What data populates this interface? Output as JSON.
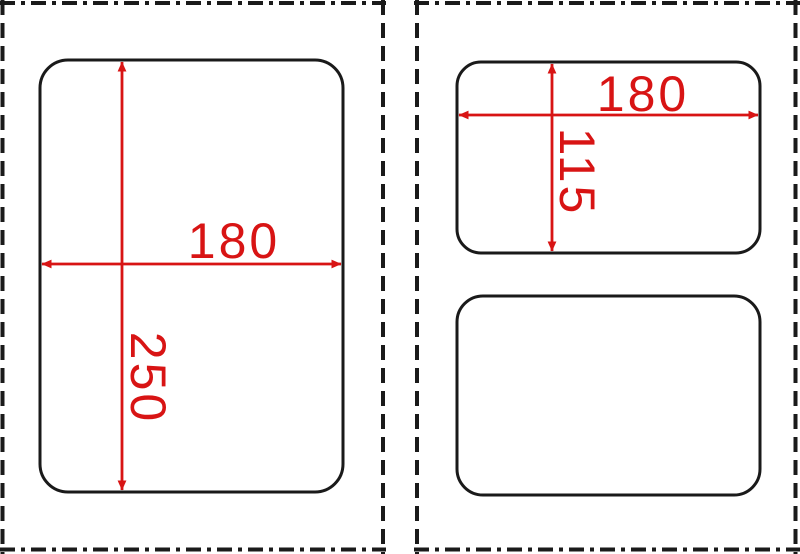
{
  "colors": {
    "outline_black": "#1a1a1a",
    "dimension_red": "#d81414",
    "background": "#ffffff"
  },
  "left_panel": {
    "shape": {
      "width_label": "180",
      "height_label": "250"
    }
  },
  "right_panel": {
    "top_shape": {
      "width_label": "180",
      "height_label": "115"
    },
    "bottom_shape": {}
  }
}
